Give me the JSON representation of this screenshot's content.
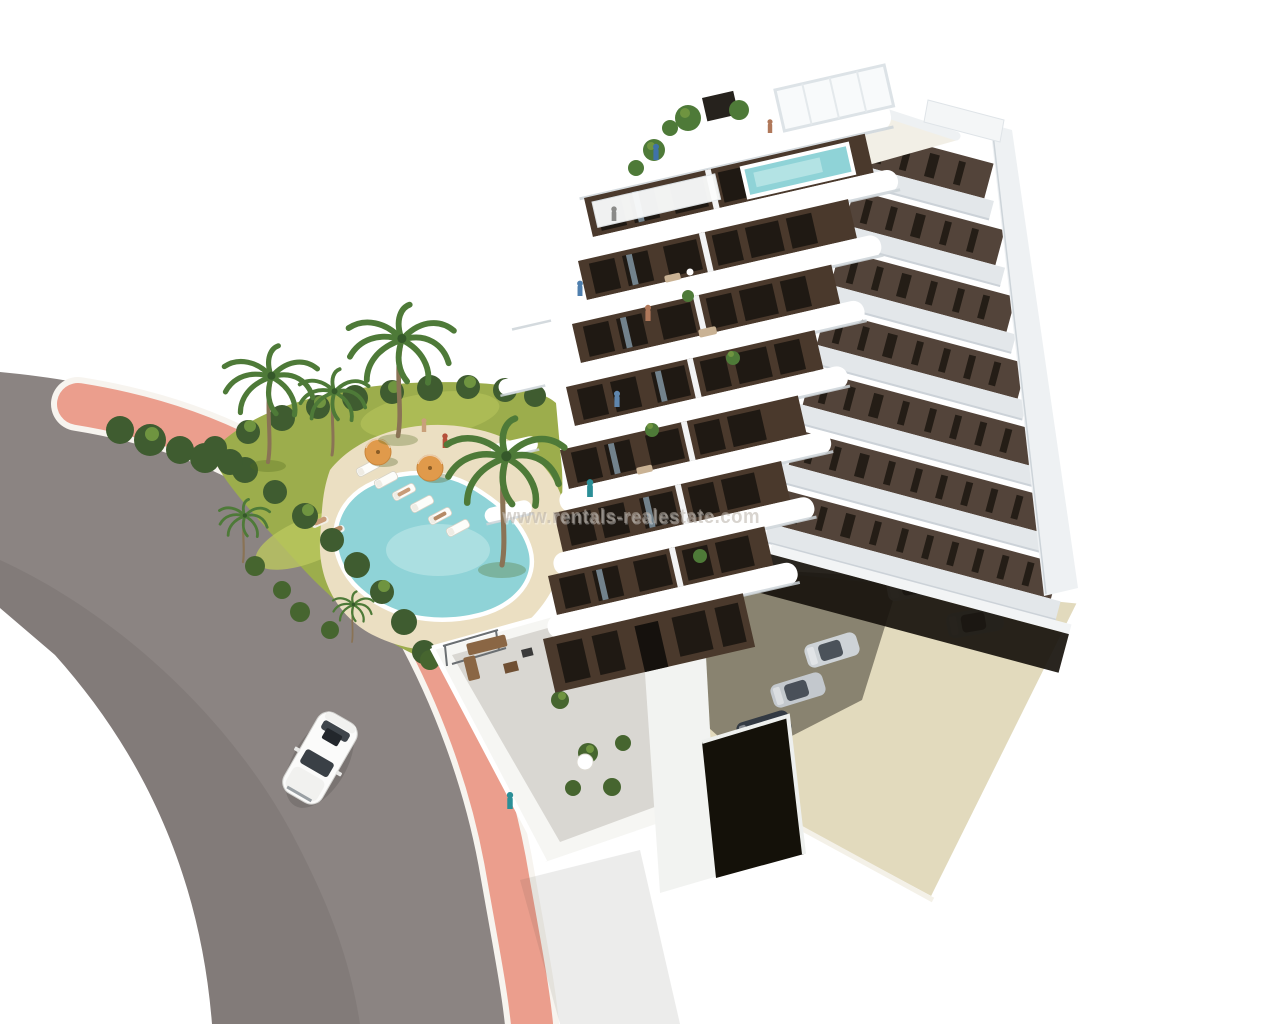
{
  "watermark": {
    "text": "www.rentals-realestate.com",
    "color": "#b9b1a8",
    "echo_color": "#ffffff"
  },
  "scene": {
    "description": "Aerial 3D architectural rendering of a modern white apartment tower with dark-brown window bays and curved white balcony bands, rooftop terraces with plunge pool and pergola, landscaped garden with free-form swimming pool, sun loungers, parasols and palm trees, a curved asphalt street with pink pavement and a white car, and an open residents' parking area with silver and dark cars on a white background",
    "elements": {
      "building": "8-storey apartment tower with curved white balcony bands",
      "rooftop": "roof terrace with plunge pool, pergola, dark chimney box and potted plants",
      "garden": "lawn with free-form turquoise pool, beige sun deck, six loungers and two orange parasols",
      "hedge": "dark green hedge and shrubs bordering the pink pavement",
      "palms": "tall palm trees in the garden",
      "road": "curved grey asphalt street with pink pedestrian pavement and white kerbs",
      "street_car": "white car driving on the street",
      "parking": "ground-level parking: two silver cars in the open, a row of silver and dark cars under the building",
      "terraces": "ground-floor private terraces with outdoor furniture and plants",
      "people": "small resident figures on the roof, balconies, pool deck, lawn and terraces"
    },
    "colors": {
      "background": "#ffffff",
      "road": "#8b8482",
      "road_shade": "rgba(55,50,47,0.10)",
      "curb": "#f7f4ef",
      "sidewalk": "#eb9e8d",
      "lawn": "#9cad4c",
      "lawn_light": "#bac75e",
      "lawn_dark": "#7d9a41",
      "hedge": "#3f5c30",
      "palm": "#4e7a38",
      "trunk": "#8a7355",
      "pool_water": "#8fd3d7",
      "pool_water_light": "#c2e9ea",
      "pool_deck": "#ebdfc2",
      "facade_brown": "#4a392c",
      "facade_brown_shaded": "#53443a",
      "window_dark": "#1f1913",
      "band_white": "#ffffff",
      "band_shadow": "#ccd3d8",
      "side_white": "#eef1f3",
      "roof_deck": "#f2efe6",
      "chimney": "#26221d",
      "apron": "#e2dabd",
      "void_dark": "#17120c",
      "garage_dark": "#141109",
      "car_white": "#fbfbfa",
      "car_silver": "#ced3d7",
      "car_dark": "#333a43",
      "umbrella": "#e09a4b",
      "furniture": "#8a6644",
      "terrace_floor": "#d9d7d2",
      "terrace_wall": "#f6f6f3"
    }
  }
}
